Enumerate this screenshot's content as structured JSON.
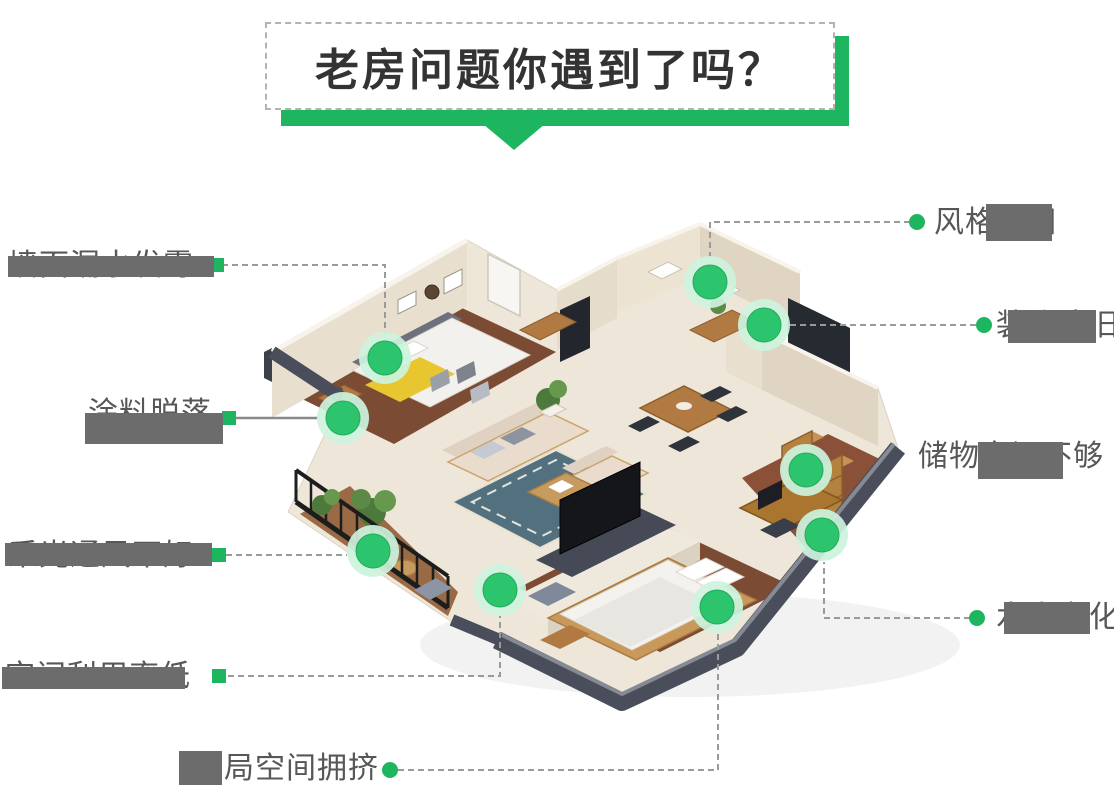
{
  "title": {
    "text": "老房问题你遇到了吗？"
  },
  "colors": {
    "accent_green": "#1db55f",
    "dot_green": "#2cc46c",
    "dot_halo": "#cdf3de",
    "label_text": "#575757",
    "redaction_gray": "#6c6c6c",
    "line_gray": "#9a9a9a"
  },
  "callouts": [
    {
      "label": "墙面漏水发霉",
      "side": "left",
      "partially_redacted": true
    },
    {
      "label": "涂料脱落",
      "side": "left",
      "partially_redacted": true
    },
    {
      "label": "采光通风不好",
      "side": "left",
      "partially_redacted": true
    },
    {
      "label": "空间利用率低",
      "side": "left",
      "partially_redacted": true
    },
    {
      "label": "布局空间拥挤",
      "side": "bottom",
      "partially_redacted": true
    },
    {
      "label": "风格陈旧",
      "side": "right",
      "partially_redacted": true
    },
    {
      "label": "装修陈旧",
      "side": "right",
      "partially_redacted": true
    },
    {
      "label": "储物空间不够",
      "side": "right",
      "partially_redacted": true
    },
    {
      "label": "水电老化",
      "side": "right",
      "partially_redacted": true
    }
  ]
}
